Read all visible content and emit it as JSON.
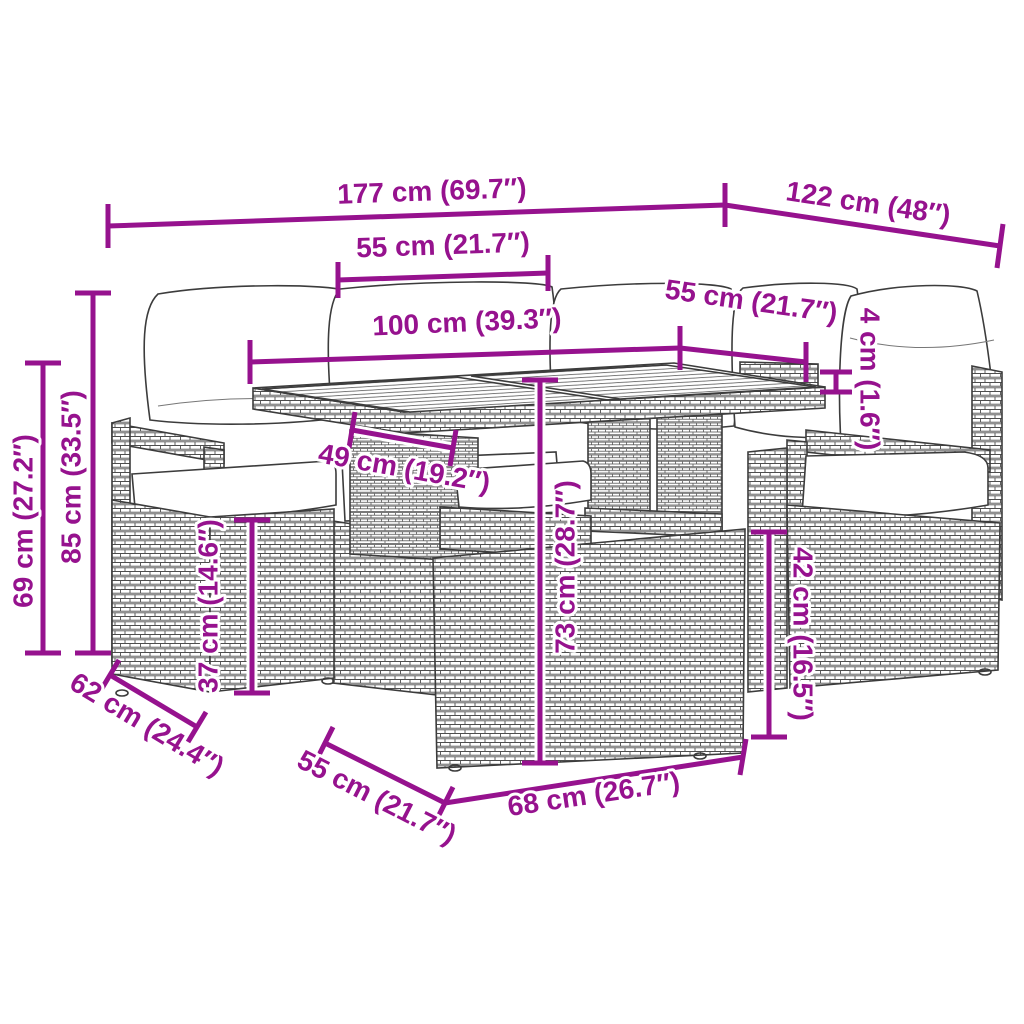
{
  "title": "Rattan garden furniture set — dimension diagram",
  "colors": {
    "dimension": "#96128E",
    "outline": "#3c3c3c",
    "background": "#ffffff"
  },
  "dims": [
    {
      "id": "total-width",
      "label": "177 cm (69.7″)"
    },
    {
      "id": "total-depth",
      "label": "122 cm (48″)"
    },
    {
      "id": "left-seat-width",
      "label": "55 cm (21.7″)"
    },
    {
      "id": "table-length",
      "label": "100 cm (39.3″)"
    },
    {
      "id": "right-seat-width",
      "label": "55 cm (21.7″)"
    },
    {
      "id": "tabletop-thickness",
      "label": "4 cm (1.6″)"
    },
    {
      "id": "backrest-height",
      "label": "85 cm (33.5″)"
    },
    {
      "id": "armrest-height",
      "label": "69 cm (27.2″)"
    },
    {
      "id": "table-support-width",
      "label": "49 cm (19.2″)"
    },
    {
      "id": "seat-height",
      "label": "37 cm (14.6″)"
    },
    {
      "id": "table-height",
      "label": "73 cm (28.7″)"
    },
    {
      "id": "side-seat-height",
      "label": "42 cm (16.5″)"
    },
    {
      "id": "seat-depth",
      "label": "62 cm (24.4″)"
    },
    {
      "id": "bench-depth",
      "label": "55 cm (21.7″)"
    },
    {
      "id": "bench-width",
      "label": "68 cm (26.7″)"
    }
  ]
}
